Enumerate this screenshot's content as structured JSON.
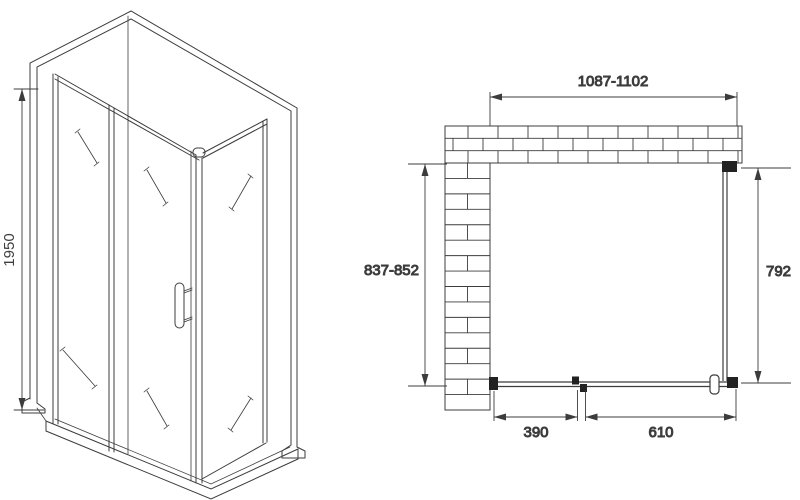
{
  "side_view": {
    "height": "1950"
  },
  "plan_view": {
    "width_range": "1087-1102",
    "depth_range": "837-852",
    "side_width": "792",
    "door_width": "390",
    "panel_width": "610"
  },
  "colors": {
    "line": "#3c3c3c",
    "text": "#3f3f3f",
    "connector": "#222222"
  }
}
